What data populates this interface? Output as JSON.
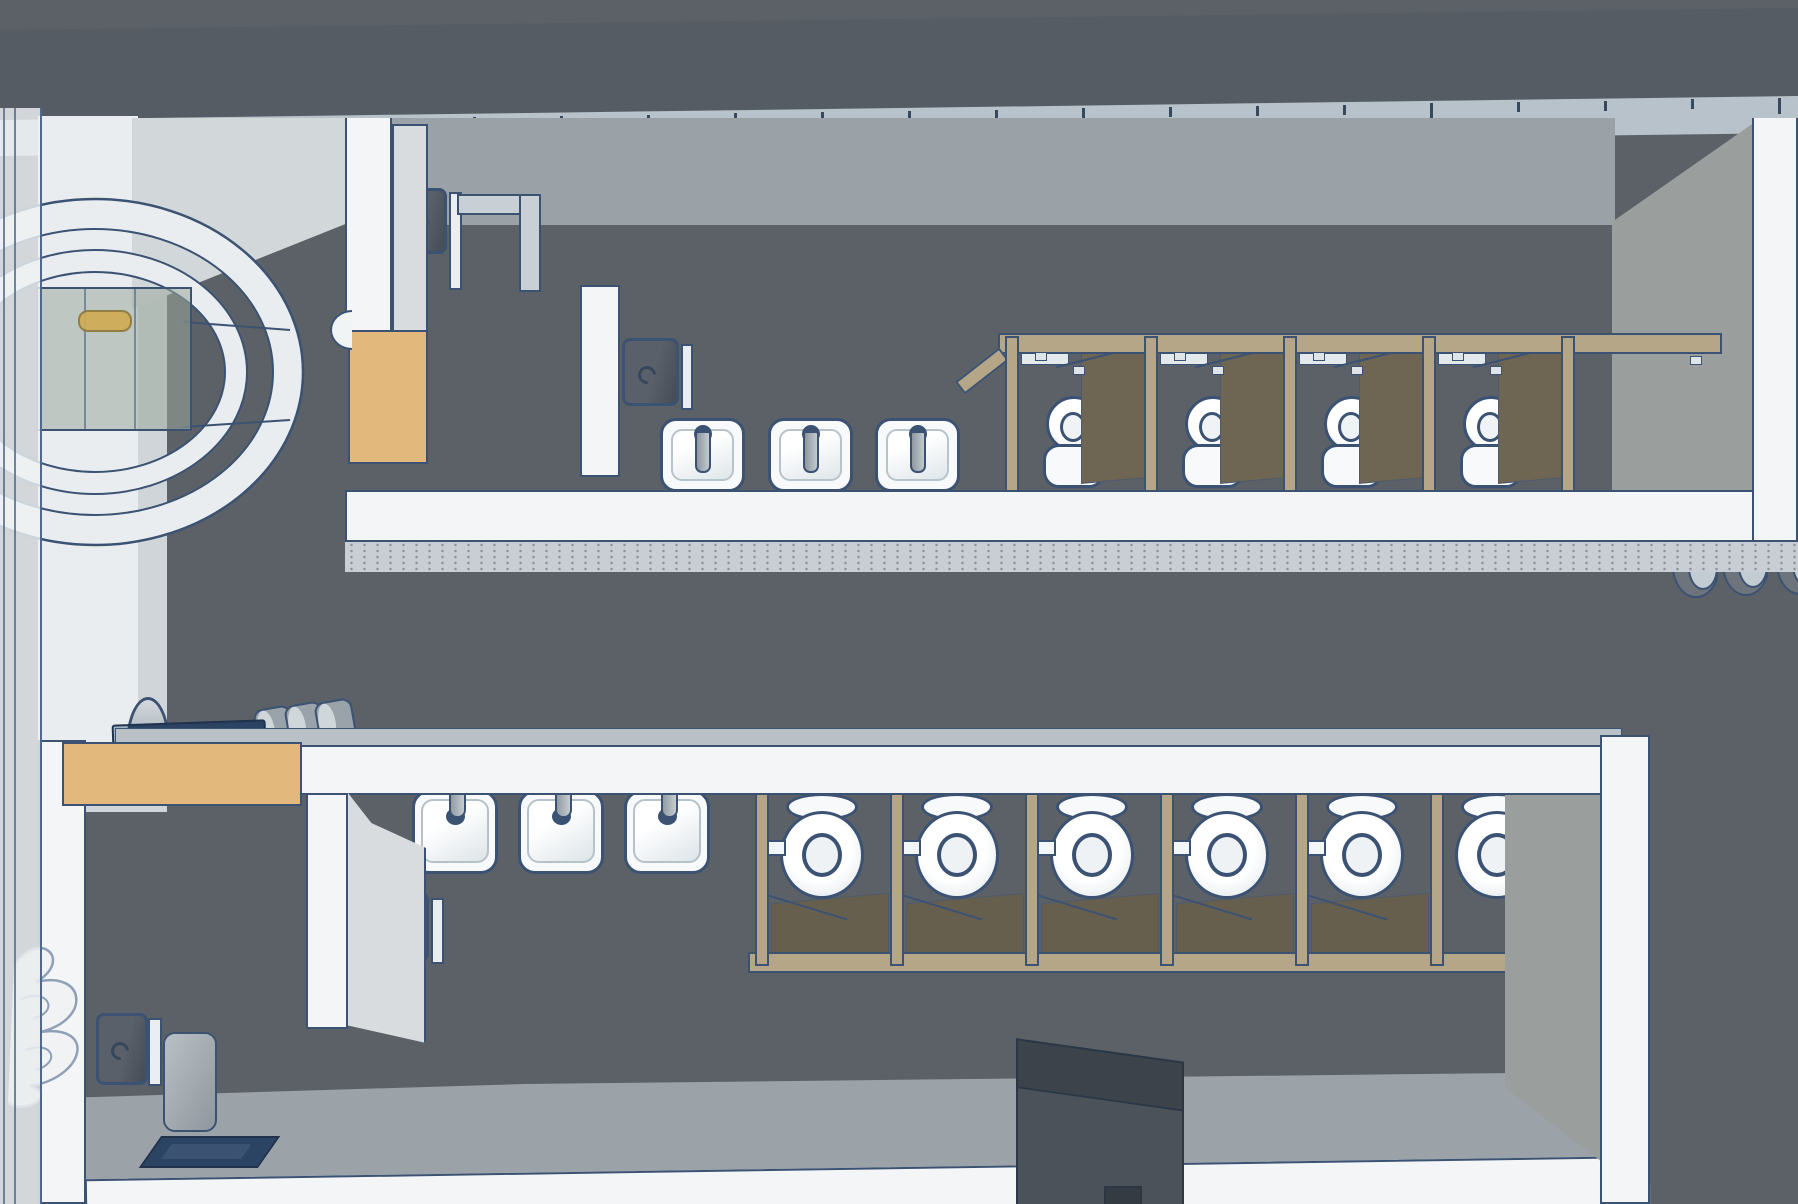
{
  "scene": {
    "app_context": "3d-model-viewport",
    "description": "Top-down 3D model of two public restrooms",
    "palette": {
      "floor": "#5b6167",
      "band": "#555c63",
      "ruler": "#b8c2ca",
      "outline": "#3b5273",
      "wall_white": "#f3f5f6",
      "wall_light": "#d3d8db",
      "room_upper": "#9aa2a8",
      "right_face": "#9a9e9d",
      "ledge": "#c8ced3",
      "tan_counter": "#e3b87d",
      "wood": "#b5a687",
      "door_olive": "#6e6553",
      "fixture_white": "#f7f9fa",
      "dryer_gray": "#4d545d",
      "navy": "#2c4463",
      "glass": "rgba(154,168,156,0.55)",
      "pill_yellow": "#d0ab52",
      "floor_light": "#9ba2a8",
      "box_gray": "#454c54"
    },
    "ruler_ticks": {
      "count": 21,
      "start_x": 38,
      "step": 87,
      "y_left": 124,
      "slope": -0.0145,
      "long_every": 4
    },
    "top_room": {
      "urinal_count": 3,
      "urinals": {
        "x": [
          660,
          768,
          875
        ],
        "y": 418
      },
      "stalls": {
        "rail": {
          "x1": 998,
          "x2": 1722,
          "y": 333,
          "h": 21
        },
        "posts": {
          "x": [
            1005,
            1144,
            1283,
            1422,
            1561
          ],
          "y": 336,
          "h": 156,
          "w": 14
        },
        "toilet_centers_x": [
          1075,
          1214,
          1353,
          1492
        ],
        "toilet_y": 396
      },
      "hand_dryer": {
        "x": 397,
        "y": 188,
        "w": 50,
        "h": 66
      },
      "soap_dispenser": {
        "x": 622,
        "y": 338,
        "w": 57,
        "h": 68
      },
      "wall_bottom_y": 490
    },
    "bottom_room": {
      "sink_count": 3,
      "sinks": {
        "x": [
          412,
          518,
          624
        ],
        "y": 752
      },
      "stalls": {
        "posts": {
          "x": [
            755,
            890,
            1025,
            1160,
            1295,
            1430
          ],
          "y": 766,
          "h": 200,
          "w": 14
        },
        "toilet_centers_x": [
          822,
          957,
          1092,
          1227,
          1362,
          1497
        ],
        "toilet_y": 793,
        "bottom_rail": {
          "x1": 748,
          "x2": 1597,
          "y": 952,
          "h": 21
        }
      },
      "hand_dryer": {
        "x": 363,
        "y": 892,
        "w": 66,
        "h": 70
      },
      "corner_dryer": {
        "x": 96,
        "y": 1013,
        "w": 52,
        "h": 72
      }
    },
    "counter_items": {
      "cylinders": [
        {
          "x": 256,
          "y": 707
        },
        {
          "x": 287,
          "y": 703
        },
        {
          "x": 317,
          "y": 700
        }
      ],
      "dome": {
        "x": 126,
        "y": 697
      },
      "tray": {
        "x": 112,
        "y": 722,
        "w": 150,
        "h": 22
      }
    },
    "c_fixtures": [
      {
        "x": 1672,
        "y": 552
      },
      {
        "x": 1722,
        "y": 550
      },
      {
        "x": 1776,
        "y": 549
      }
    ],
    "vestibule": {
      "glass_box": {
        "x": 36,
        "y": 287,
        "w": 152,
        "h": 140
      },
      "pill": {
        "x": 78,
        "y": 310,
        "w": 50,
        "h": 18
      }
    }
  }
}
